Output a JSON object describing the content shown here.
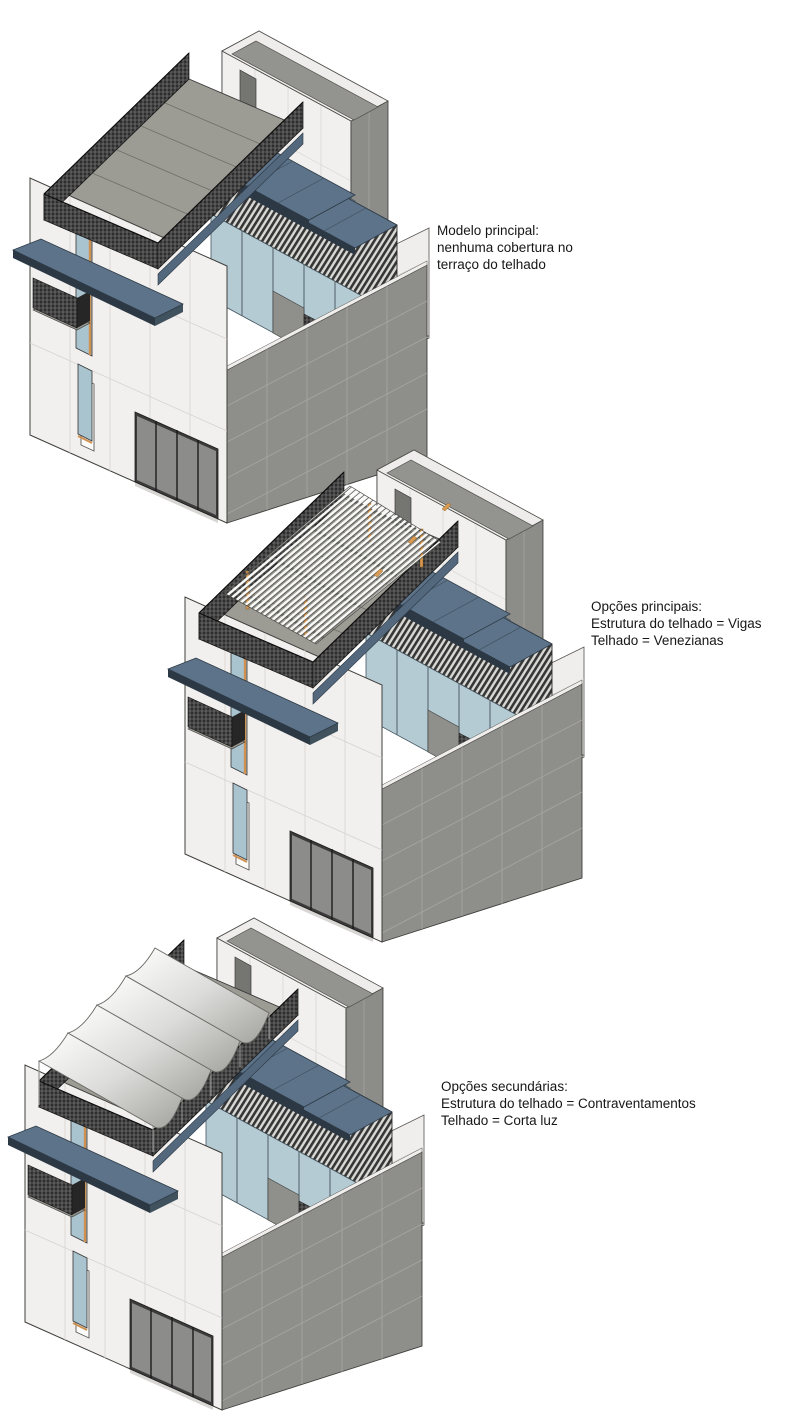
{
  "page": {
    "background": "#ffffff",
    "description_of_visual": "Three isometric Revit renderings of the same building showing design options for the roof terrace"
  },
  "figures": [
    {
      "id": "main-model",
      "option": "no-roof-structure",
      "caption_lines": [
        "Modelo principal:",
        "nenhuma cobertura no",
        "terraço do telhado"
      ]
    },
    {
      "id": "primary-options",
      "option": "beams-with-louvers",
      "caption_lines": [
        "Opções principais:",
        "Estrutura do telhado = Vigas",
        "Telhado = Venezianas"
      ]
    },
    {
      "id": "secondary-options",
      "option": "bracing-with-shade-sails",
      "caption_lines": [
        "Opções secundárias:",
        "Estrutura do telhado = Contraventamentos",
        "Telhado = Corta luz"
      ]
    }
  ],
  "colors": {
    "wall_white": "#f2f0ee",
    "wall_gray": "#8e8e8a",
    "roof_deck": "#9c9b94",
    "canopy_blue": "#5d7389",
    "canopy_edge_dark": "#2c3945",
    "lattice_dark": "#2e2e2e",
    "glass": "#b5cbd4",
    "wood_post_orange": "#d89a50",
    "sail_white": "#ffffff"
  }
}
